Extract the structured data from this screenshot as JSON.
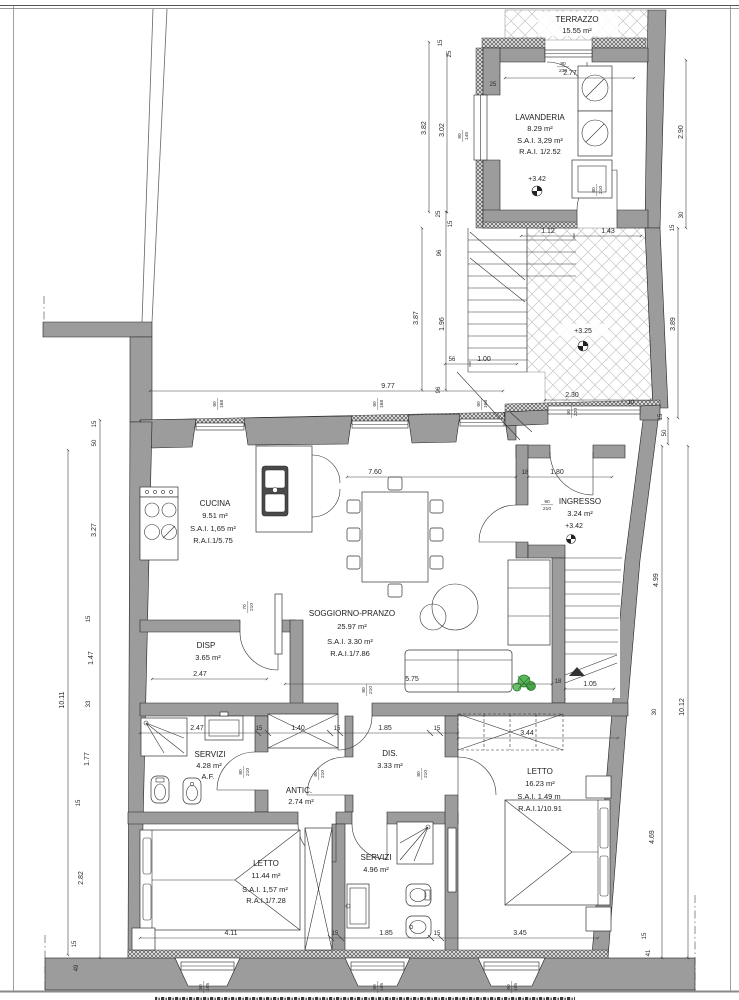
{
  "drawing": {
    "type": "architectural-floor-plan",
    "rooms": [
      {
        "id": "terrazzo",
        "name": "TERRAZZO",
        "area": "15.55 m²"
      },
      {
        "id": "lavanderia",
        "name": "LAVANDERIA",
        "area": "8.29 m²",
        "sai": "S.A.I. 3,29 m²",
        "rai": "R.A.I. 1/2.52",
        "level": "+3.42"
      },
      {
        "id": "ingresso",
        "name": "INGRESSO",
        "area": "3.24 m²",
        "level": "+3.42"
      },
      {
        "id": "cucina",
        "name": "CUCINA",
        "area": "9.51 m²",
        "sai": "S.A.I. 1,65 m²",
        "rai": "R.A.I.1/5.75"
      },
      {
        "id": "soggiorno",
        "name": "SOGGIORNO-PRANZO",
        "area": "25.97 m²",
        "sai": "S.A.I. 3.30 m²",
        "rai": "R.A.I.1/7.86"
      },
      {
        "id": "disp",
        "name": "DISP",
        "area": "3.65 m²"
      },
      {
        "id": "servizi1",
        "name": "SERVIZI",
        "area": "4.28 m²",
        "note": "A.F."
      },
      {
        "id": "antic",
        "name": "ANTIC.",
        "area": "2.74 m²"
      },
      {
        "id": "dis",
        "name": "DIS.",
        "area": "3.33 m²"
      },
      {
        "id": "letto2",
        "name": "LETTO",
        "area": "16.23 m²",
        "sai": "S.A.I. 1.49 m",
        "rai": "R.A.I.1/10.91"
      },
      {
        "id": "letto1",
        "name": "LETTO",
        "area": "11.44 m²",
        "sai": "S.A.I. 1,57 m²",
        "rai": "R.A.I.1/7.28"
      },
      {
        "id": "servizi2",
        "name": "SERVIZI",
        "area": "4.96 m²"
      }
    ],
    "levels": {
      "terrace": "+3.25",
      "upper": "+3.42"
    },
    "dims": {
      "d277": "2.77",
      "d112": "1.12",
      "d143": "1.43",
      "d100": "1.00",
      "d230": "2.30",
      "d977": "9.77",
      "d760": "7.60",
      "d180": "1.80",
      "d247": "2.47",
      "d575": "5.75",
      "d105": "1.05",
      "d140": "1.40",
      "d185": "1.85",
      "d344": "3.44",
      "d411": "4.11",
      "d345": "3.45",
      "v1011": "10.11",
      "v382": "3.82",
      "v302": "3.02",
      "v196": "1.96",
      "v387": "3.87",
      "v327": "3.27",
      "v147": "1.47",
      "v177": "1.77",
      "v282": "2.82",
      "v290": "2.90",
      "v389": "3.89",
      "v499": "4.99",
      "v469": "4.69",
      "v1012": "10.12",
      "t10": "10",
      "t15": "15",
      "t18": "18",
      "t25": "25",
      "t30": "30",
      "t33": "33",
      "t41": "41",
      "t49": "49",
      "t50": "50",
      "t56": "56",
      "t96": "96"
    },
    "tags": {
      "w90": "90",
      "w80": "80",
      "w70": "70",
      "h210": "210",
      "h230": "230",
      "h145": "145",
      "h220": "220",
      "h168": "168",
      "h165": "165"
    }
  }
}
